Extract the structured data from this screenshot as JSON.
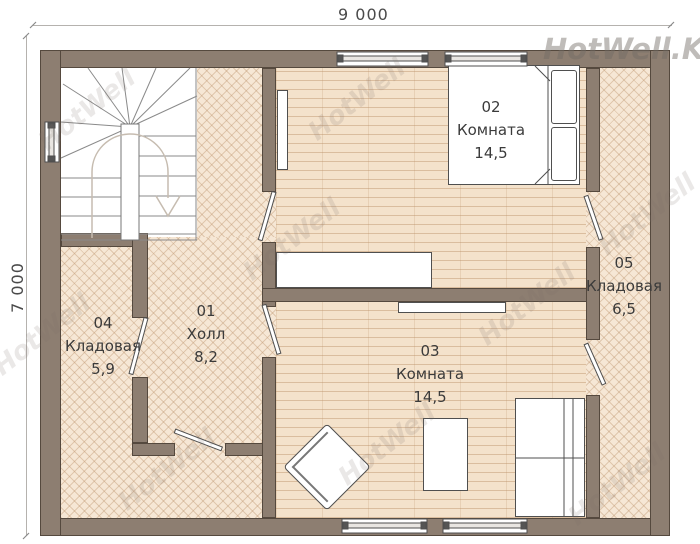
{
  "dimensions": {
    "width_label": "9 000",
    "height_label": "7 000"
  },
  "rooms": [
    {
      "number": "01",
      "name": "Холл",
      "area": "8,2"
    },
    {
      "number": "02",
      "name": "Комната",
      "area": "14,5"
    },
    {
      "number": "03",
      "name": "Комната",
      "area": "14,5"
    },
    {
      "number": "04",
      "name": "Кладовая",
      "area": "5,9"
    },
    {
      "number": "05",
      "name": "Кладовая",
      "area": "6,5"
    }
  ],
  "watermark": {
    "text": "HotWell",
    "corner_text": "HotWell.Kz"
  },
  "colors": {
    "wall": "#8d7e71",
    "wall_outline": "#55493e",
    "floor_plank": "#f4e2cb",
    "floor_herringbone": "#f6e7d5",
    "dimension_text": "#4a4a4a",
    "label_text": "#3b3b3b"
  }
}
